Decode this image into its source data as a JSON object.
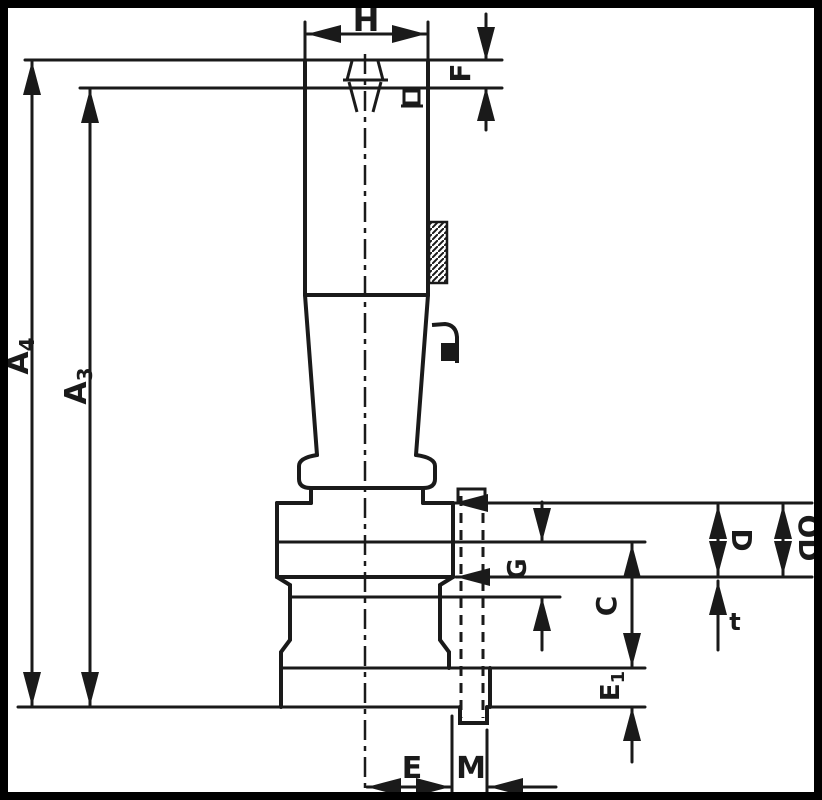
{
  "drawing": {
    "title": "retention-knob-dimension-drawing",
    "labels": {
      "h": "H",
      "f": "F",
      "a4": {
        "base": "A",
        "sub": "4"
      },
      "a3": {
        "base": "A",
        "sub": "3"
      },
      "d": "D",
      "od": "OD",
      "g": "G",
      "c": "C",
      "t": "t",
      "e1": {
        "base": "E",
        "sub": "1"
      },
      "e": "E",
      "m": "M"
    },
    "colors": {
      "line": "#1a1a1a",
      "background": "#ffffff",
      "frame": "#000000"
    }
  }
}
